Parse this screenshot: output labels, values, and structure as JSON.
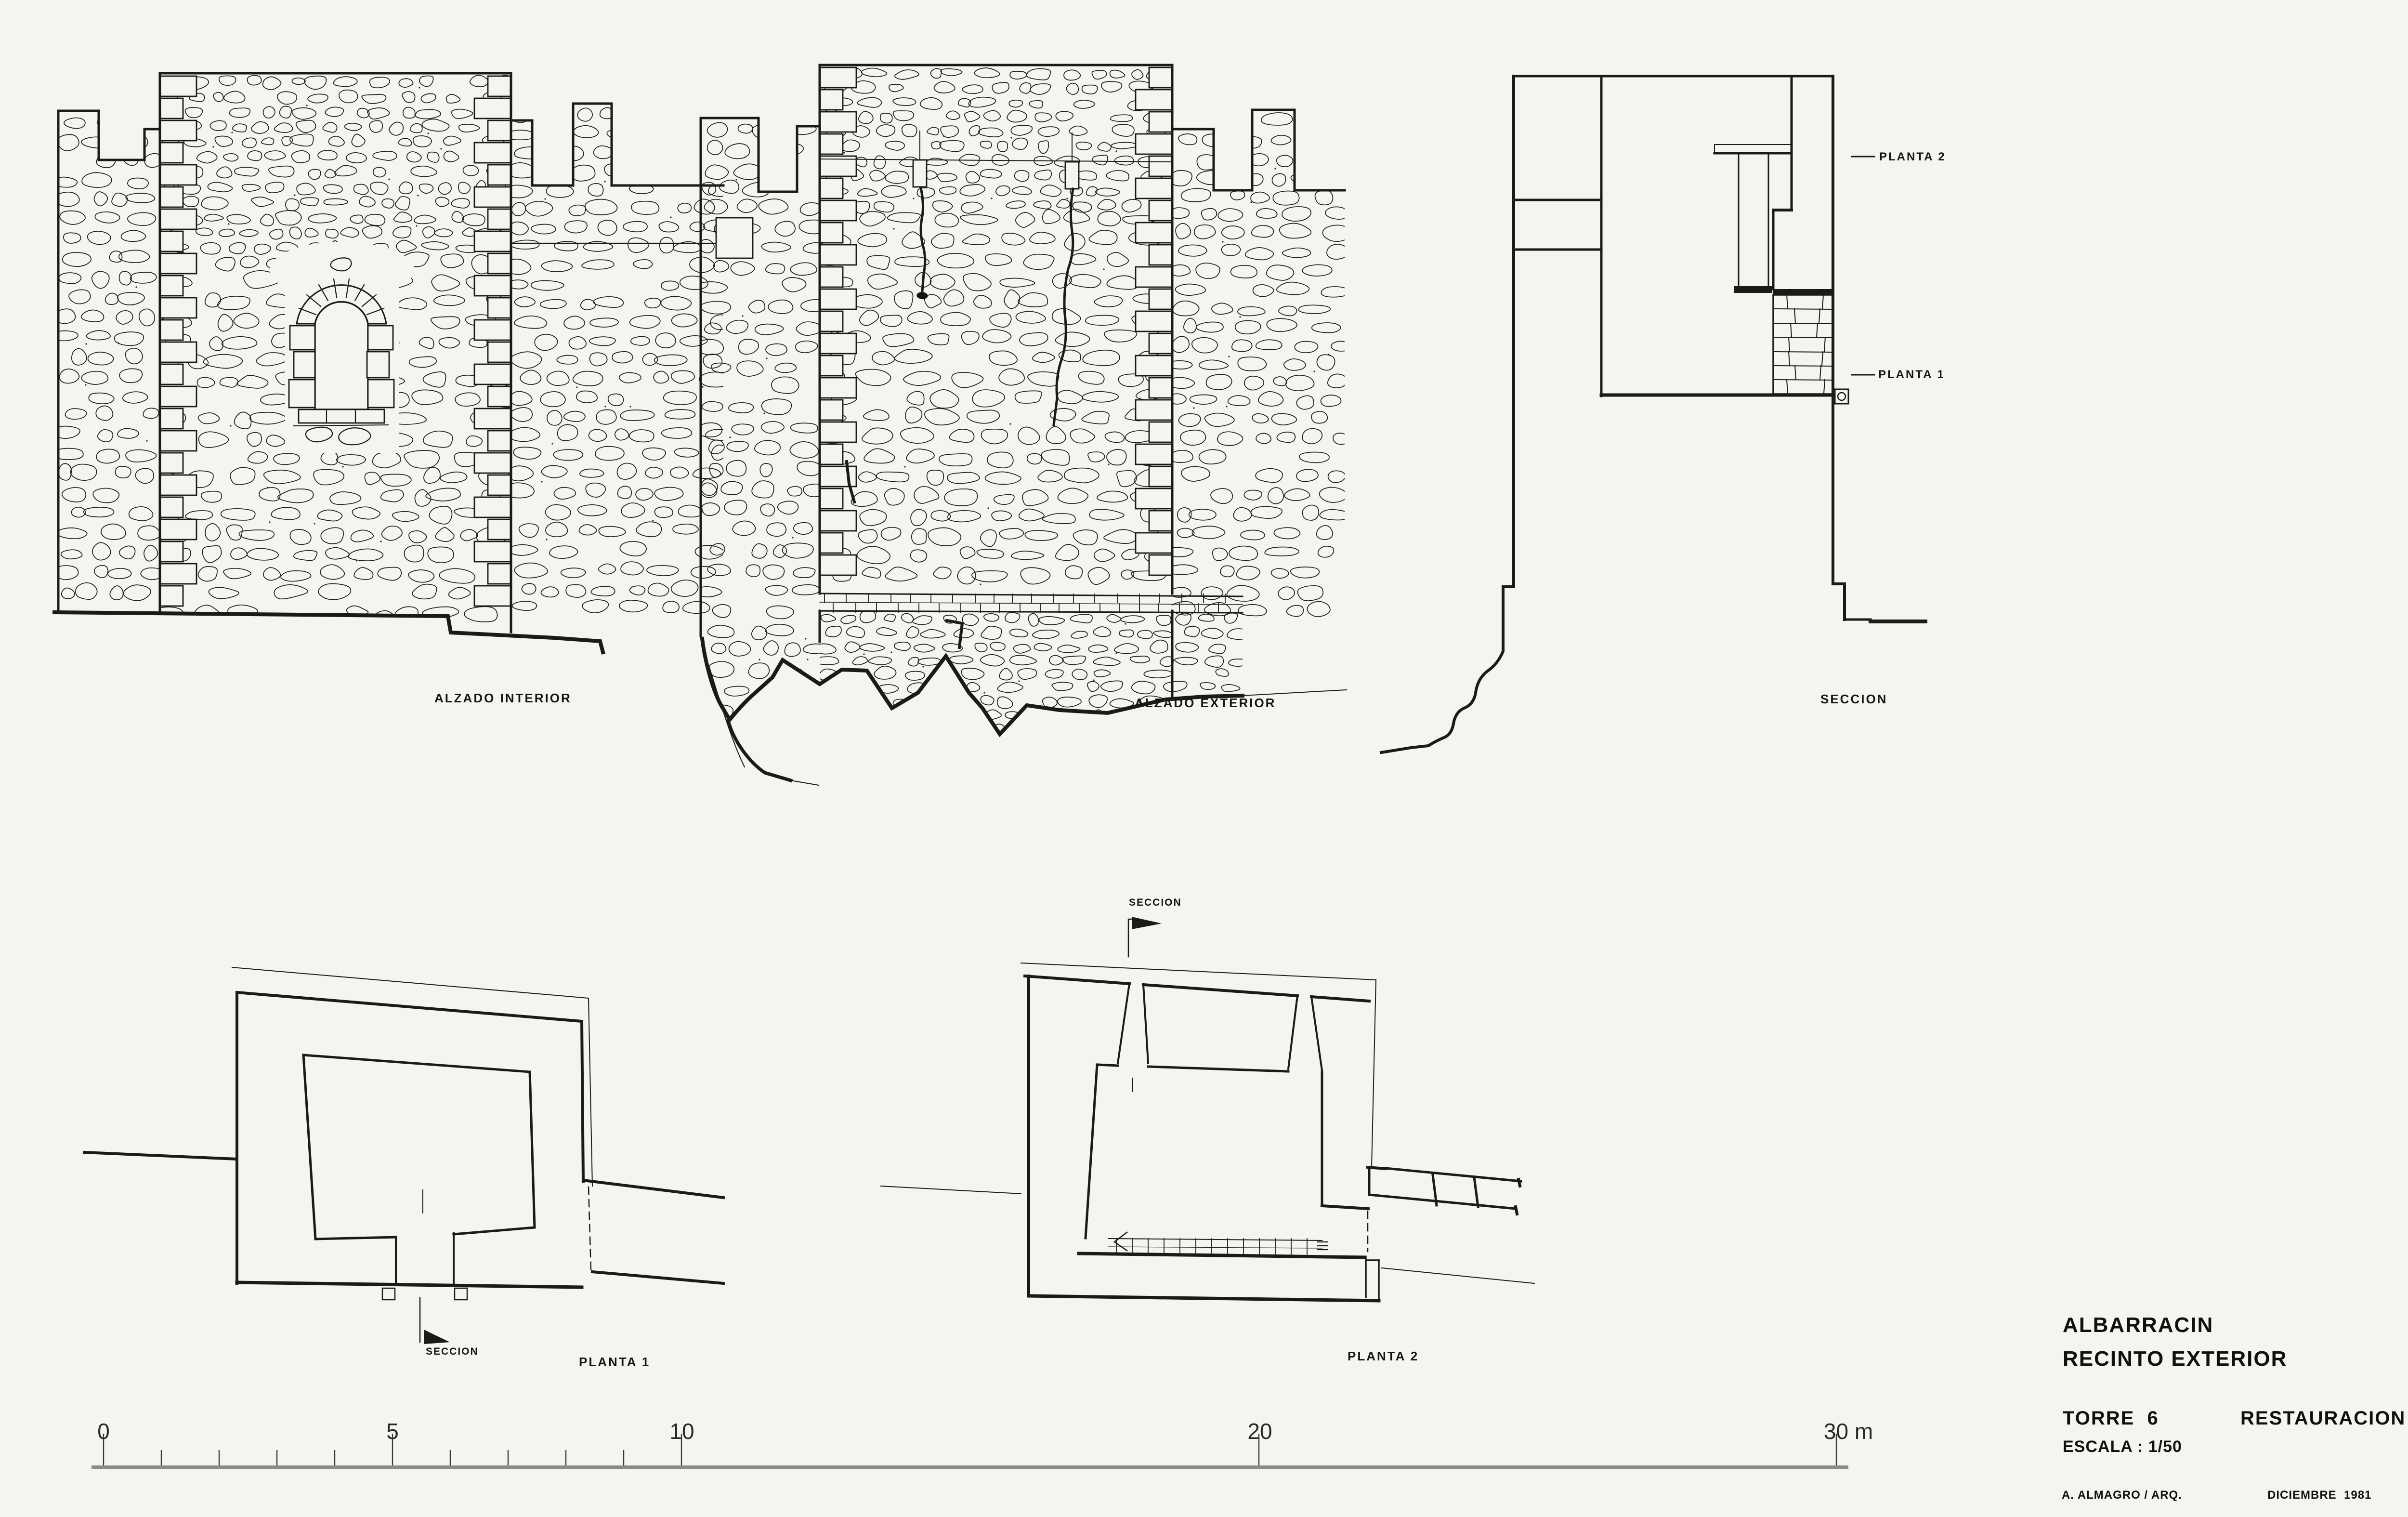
{
  "sheet": {
    "paper_color": "#f5f4ef",
    "ink_color": "#1a1a1a"
  },
  "drawings": {
    "alzado_interior": {
      "label": "ALZADO INTERIOR"
    },
    "alzado_exterior": {
      "label": "ALZADO EXTERIOR"
    },
    "seccion": {
      "label": "SECCION",
      "level_refs": {
        "planta_2": "PLANTA 2",
        "planta_1": "PLANTA 1"
      }
    },
    "planta_1": {
      "label": "PLANTA 1",
      "section_marker": "SECCION"
    },
    "planta_2": {
      "label": "PLANTA 2",
      "section_marker": "SECCION"
    }
  },
  "scale_bar": {
    "labels": [
      "0",
      "5",
      "10",
      "20",
      "30 m"
    ],
    "positions_m": [
      0,
      5,
      10,
      20,
      30
    ],
    "minor_tick_interval_m": 1,
    "minor_ticks_up_to_m": 10
  },
  "title_block": {
    "site": "ALBARRACIN",
    "area": "RECINTO EXTERIOR",
    "element": "TORRE  6",
    "project_type": "RESTAURACION",
    "scale": "ESCALA : 1/50",
    "architect": "A. ALMAGRO / ARQ.",
    "date": "DICIEMBRE  1981"
  }
}
